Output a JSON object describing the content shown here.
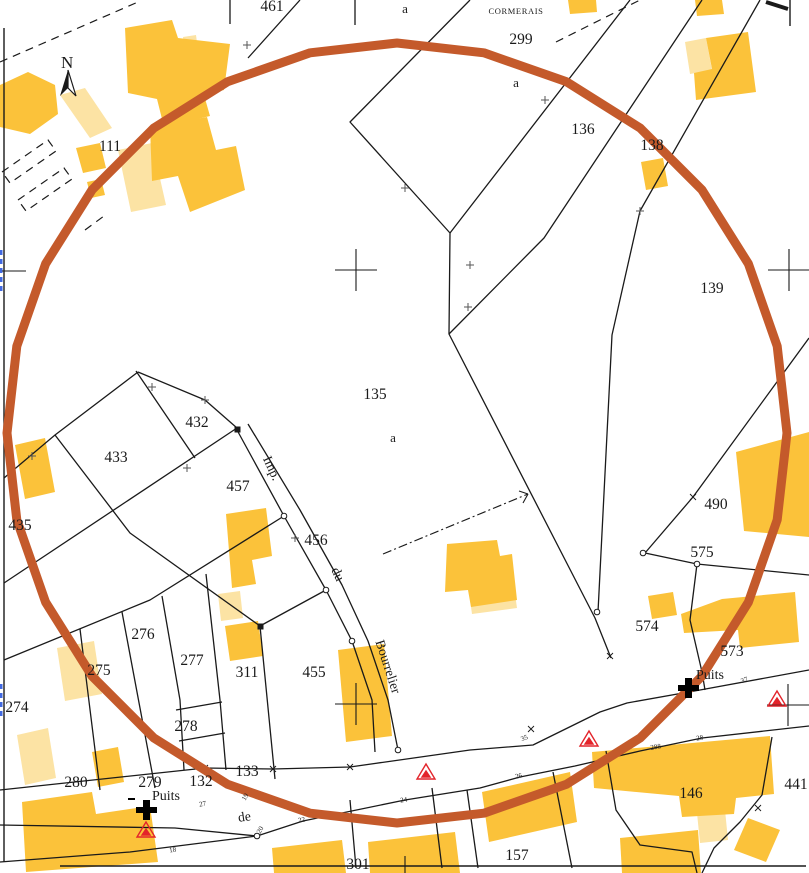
{
  "map": {
    "title": "cadastral-plan-extract",
    "place_label": "CORMERAIS",
    "north_label": "N",
    "colors": {
      "building_main": "#FBC23A",
      "building_light": "#FCE3A4",
      "circle_overlay": "#C45A2B",
      "triangle_marker": "#E3242B",
      "sheet_edge_tick": "#4169E1",
      "line": "#1a1a1a"
    },
    "parcel_labels": [
      {
        "text": "461",
        "x": 272,
        "y": 11
      },
      {
        "text": "299",
        "x": 521,
        "y": 44
      },
      {
        "text": "111",
        "x": 110,
        "y": 151
      },
      {
        "text": "136",
        "x": 583,
        "y": 134
      },
      {
        "text": "138",
        "x": 652,
        "y": 150
      },
      {
        "text": "139",
        "x": 712,
        "y": 293
      },
      {
        "text": "135",
        "x": 375,
        "y": 399
      },
      {
        "text": "432",
        "x": 197,
        "y": 427
      },
      {
        "text": "433",
        "x": 116,
        "y": 462
      },
      {
        "text": "435",
        "x": 20,
        "y": 530
      },
      {
        "text": "457",
        "x": 238,
        "y": 491
      },
      {
        "text": "456",
        "x": 316,
        "y": 545
      },
      {
        "text": "455",
        "x": 314,
        "y": 677
      },
      {
        "text": "311",
        "x": 247,
        "y": 677
      },
      {
        "text": "490",
        "x": 716,
        "y": 509
      },
      {
        "text": "575",
        "x": 702,
        "y": 557
      },
      {
        "text": "574",
        "x": 647,
        "y": 631
      },
      {
        "text": "573",
        "x": 732,
        "y": 656
      },
      {
        "text": "276",
        "x": 143,
        "y": 639
      },
      {
        "text": "277",
        "x": 192,
        "y": 665
      },
      {
        "text": "275",
        "x": 99,
        "y": 675
      },
      {
        "text": "274",
        "x": 17,
        "y": 712
      },
      {
        "text": "278",
        "x": 186,
        "y": 731
      },
      {
        "text": "280",
        "x": 76,
        "y": 787
      },
      {
        "text": "279",
        "x": 150,
        "y": 787
      },
      {
        "text": "132",
        "x": 201,
        "y": 786
      },
      {
        "text": "133",
        "x": 247,
        "y": 776
      },
      {
        "text": "146",
        "x": 691,
        "y": 798
      },
      {
        "text": "157",
        "x": 517,
        "y": 860
      },
      {
        "text": "301",
        "x": 358,
        "y": 869
      },
      {
        "text": "441",
        "x": 796,
        "y": 789
      }
    ],
    "sub_letters": [
      {
        "text": "a",
        "x": 405,
        "y": 13
      },
      {
        "text": "a",
        "x": 516,
        "y": 87
      },
      {
        "text": "a",
        "x": 393,
        "y": 442
      }
    ],
    "street_labels": [
      {
        "text": "Imp.",
        "x": 268,
        "y": 470,
        "rot": 65
      },
      {
        "text": "du",
        "x": 334,
        "y": 576,
        "rot": 65
      },
      {
        "text": "Bourrelier",
        "x": 384,
        "y": 668,
        "rot": 72
      },
      {
        "text": "de",
        "x": 245,
        "y": 821,
        "rot": -8
      }
    ],
    "well_labels": [
      {
        "text": "Puits",
        "x": 166,
        "y": 800
      },
      {
        "text": "Puits",
        "x": 710,
        "y": 679
      }
    ],
    "road_numbers": [
      {
        "text": "27",
        "x": 203,
        "y": 806,
        "rot": -10
      },
      {
        "text": "19",
        "x": 247,
        "y": 798,
        "rot": -60
      },
      {
        "text": "18",
        "x": 173,
        "y": 852,
        "rot": -8
      },
      {
        "text": "20",
        "x": 262,
        "y": 831,
        "rot": -60
      },
      {
        "text": "22",
        "x": 302,
        "y": 822,
        "rot": -10
      },
      {
        "text": "24",
        "x": 404,
        "y": 802,
        "rot": -8
      },
      {
        "text": "26",
        "x": 519,
        "y": 778,
        "rot": -12
      },
      {
        "text": "35",
        "x": 525,
        "y": 740,
        "rot": -20
      },
      {
        "text": "37",
        "x": 745,
        "y": 682,
        "rot": -20
      },
      {
        "text": "28",
        "x": 700,
        "y": 740,
        "rot": -8
      },
      {
        "text": "288",
        "x": 656,
        "y": 749,
        "rot": -8
      }
    ],
    "markers": {
      "wells": [
        {
          "x": 146,
          "y": 810
        },
        {
          "x": 688,
          "y": 688
        }
      ],
      "red_triangles": [
        {
          "x": 146,
          "y": 830
        },
        {
          "x": 426,
          "y": 772
        },
        {
          "x": 589,
          "y": 739
        },
        {
          "x": 777,
          "y": 699
        }
      ],
      "survey_crosses": [
        {
          "x": 356,
          "y": 270
        },
        {
          "x": 356,
          "y": 704
        },
        {
          "x": 789,
          "y": 270
        },
        {
          "x": 788,
          "y": 705
        }
      ]
    }
  }
}
